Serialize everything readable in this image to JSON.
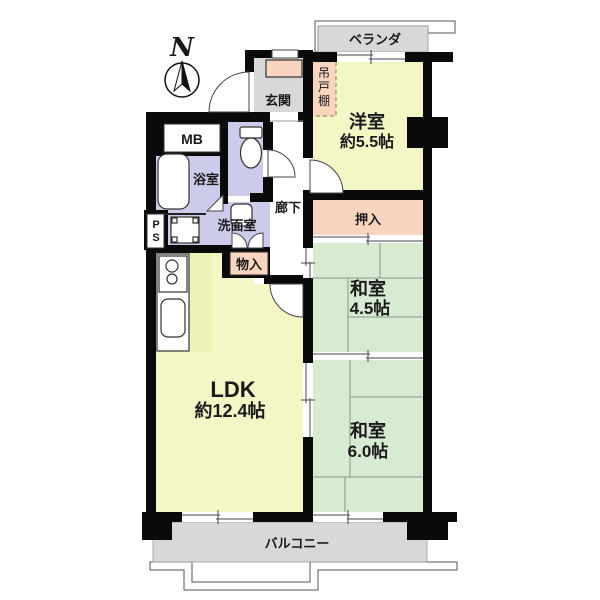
{
  "compass": {
    "north": "N"
  },
  "labels": {
    "veranda": "ベランダ",
    "balcony": "バルコニー",
    "entrance": "玄関",
    "hallway": "廊下",
    "meter_box": "MB",
    "bathroom": "浴室",
    "washroom": "洗面室",
    "closet": "押入",
    "storage": "物入",
    "pipe_space": [
      "P",
      "S"
    ],
    "hanging_cupboard": [
      "吊",
      "戸",
      "棚"
    ]
  },
  "rooms": {
    "western": {
      "name": "洋室",
      "size": "約5.5帖"
    },
    "ldk": {
      "name": "LDK",
      "size": "約12.4帖"
    },
    "japanese45": {
      "name": "和室",
      "size": "4.5帖"
    },
    "japanese60": {
      "name": "和室",
      "size": "6.0帖"
    }
  },
  "colors": {
    "wall": "#0a0a0a",
    "room_yellow": "#f4f7c5",
    "room_green": "#d7ead2",
    "wet_purple": "#ccccea",
    "accent_pink": "#f9d4be",
    "floor_gray": "#d8d8d8",
    "kitchen_strip": "#edf2b8",
    "line": "#444444"
  }
}
